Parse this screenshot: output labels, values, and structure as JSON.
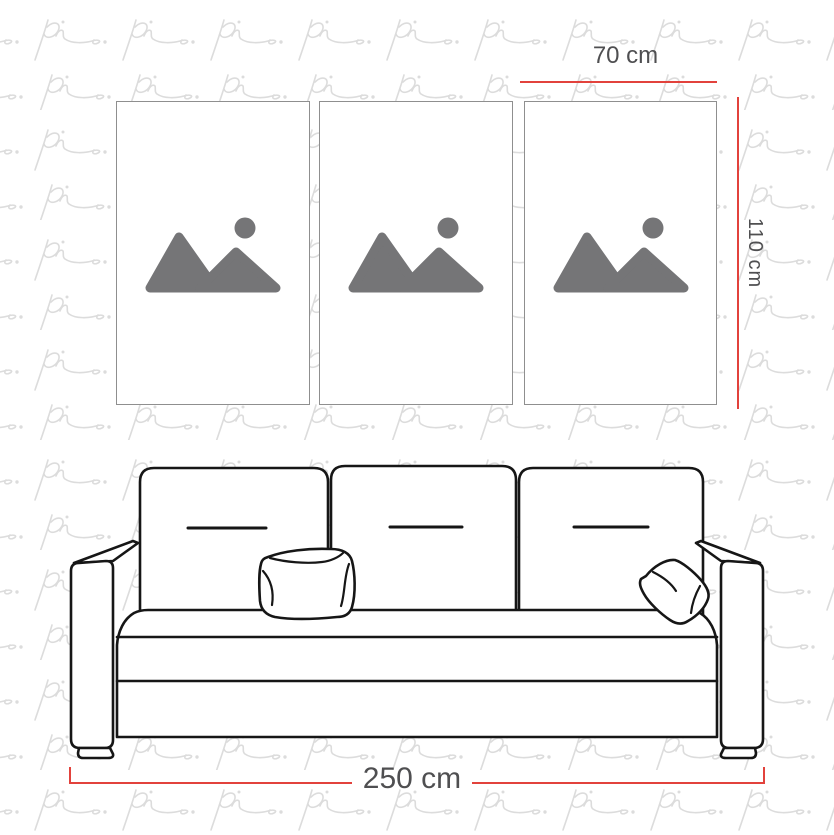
{
  "infographic": {
    "type": "wall-art-size-guide",
    "background_color": "#ffffff",
    "watermark": {
      "text": "pi",
      "color": "#dcdcdc"
    },
    "accent_color": "#e2423c",
    "label_color": "#4f4f51",
    "panels": {
      "count": 3,
      "content": "image-placeholder"
    },
    "sofa": {
      "style": "line-drawing",
      "back_cushions": 3,
      "throw_pillows": 2
    },
    "dimensions": {
      "panel_width": {
        "label": "70 cm"
      },
      "panel_height": {
        "label": "110 cm"
      },
      "sofa_width": {
        "label": "250 cm"
      }
    }
  }
}
